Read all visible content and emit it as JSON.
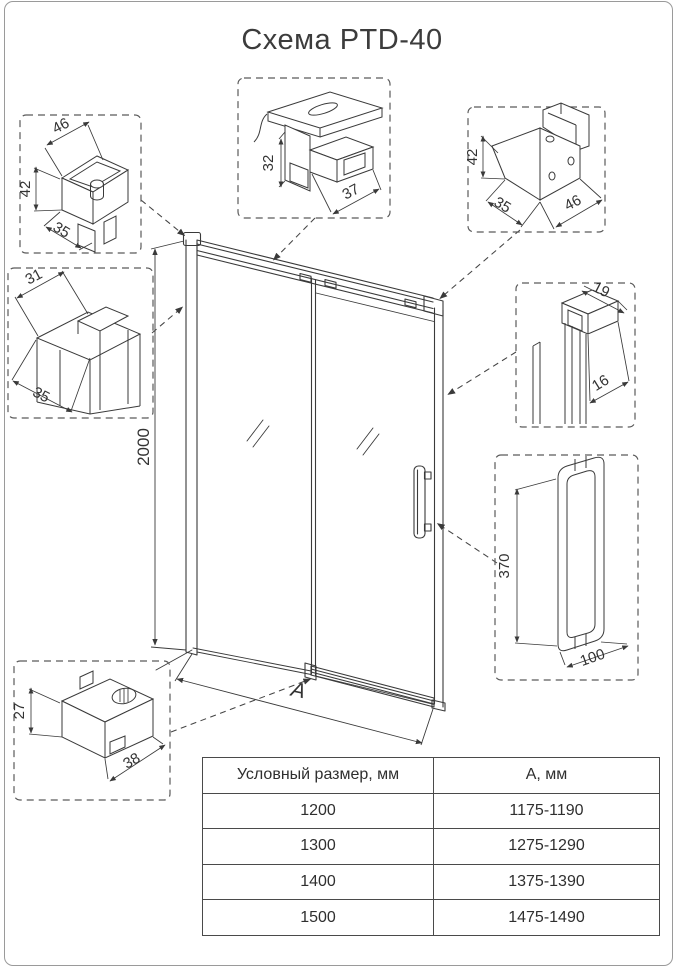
{
  "title": "Схема PTD-40",
  "diagram": {
    "overall": {
      "height": "2000",
      "width_label": "А"
    },
    "details": {
      "top_left_bracket": {
        "width": "46",
        "height": "42",
        "depth": "35"
      },
      "top_rail": {
        "height": "32",
        "depth": "37"
      },
      "top_right_bracket": {
        "height": "42",
        "depth": "35",
        "width": "46"
      },
      "wall_profile": {
        "width": "31",
        "depth": "35"
      },
      "side_profile": {
        "width": "19",
        "depth": "16"
      },
      "handle": {
        "height": "370",
        "width": "100"
      },
      "floor_guide": {
        "height": "27",
        "width": "38"
      }
    }
  },
  "table": {
    "headers": [
      "Условный размер, мм",
      "А, мм"
    ],
    "rows": [
      {
        "size": "1200",
        "a": "1175-1190"
      },
      {
        "size": "1300",
        "a": "1275-1290"
      },
      {
        "size": "1400",
        "a": "1375-1390"
      },
      {
        "size": "1500",
        "a": "1475-1490"
      }
    ]
  }
}
